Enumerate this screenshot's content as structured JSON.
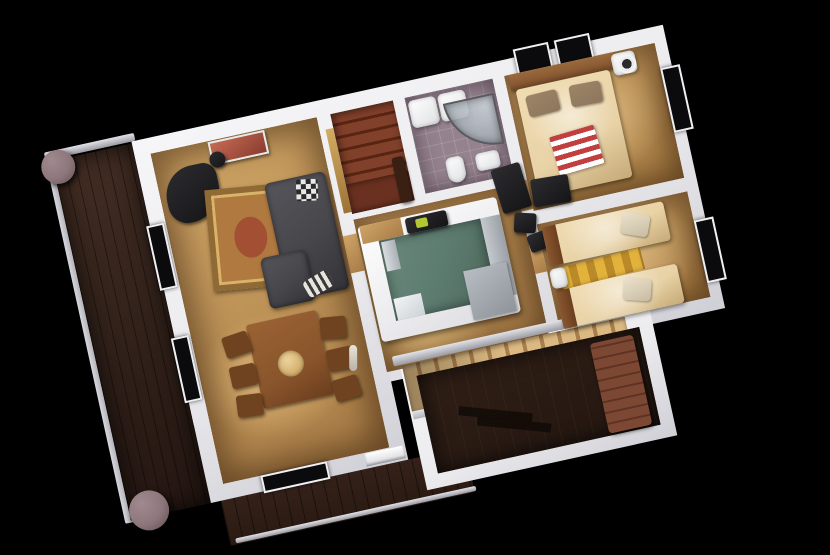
{
  "scene": {
    "type": "3d-rendered-floor-plan",
    "description": "Top-down 3D architectural render of a one-storey home interior on a black background, rotated about -12 degrees",
    "background": "#000000",
    "house_rotation_deg": -12.4
  },
  "palette": {
    "wall": "#ebebee",
    "floor_wood": "#d2a868",
    "floor_wood_dark": "#a87c46",
    "deck_dark": "#35241c",
    "deck_bottom": "#2a1a12",
    "porch_floor": "#241711",
    "bath_tile": "#94828e",
    "kitchen_teal": "#5c7b6f",
    "stairs_up_wood": "#7a3a24",
    "stairs_main_wood": "#d8b57e",
    "bed_linen": "#e8d2a6",
    "pillow_brown": "#8d765c",
    "headboard_wood": "#8a5a33",
    "blanket_red": "#c23f3f",
    "rug_gold": "#8f6a35",
    "rug_center": "#a34f33",
    "rug_yellow": "#d8a434",
    "sofa_gray": "#46464b",
    "dining_wood": "#8a552c",
    "bench_brown": "#6f3f2d",
    "pillar_concrete": "#8d777c",
    "window_glass": "#0b0b0d"
  },
  "rooms": [
    {
      "id": "living-room",
      "furniture": [
        "dark-armchair",
        "ornate-rug",
        "corner-sofa",
        "checkered-pillow",
        "zebra-throw"
      ]
    },
    {
      "id": "dining-area",
      "furniture": [
        "dining-table",
        "six-chairs",
        "centerpiece-bowl",
        "floor-lamp"
      ]
    },
    {
      "id": "kitchen",
      "furniture": [
        "u-shaped-counter",
        "teal-floor",
        "fridge",
        "range",
        "gray-worktop"
      ]
    },
    {
      "id": "bathroom",
      "furniture": [
        "tub-trays",
        "corner-shower",
        "toilet",
        "sink"
      ]
    },
    {
      "id": "master-bedroom",
      "furniture": [
        "double-bed",
        "headboard",
        "two-pillows",
        "red-striped-blanket",
        "nightstand-lamp",
        "black-desk"
      ]
    },
    {
      "id": "twin-bedroom",
      "furniture": [
        "single-bed-1",
        "single-bed-2",
        "yellow-striped-rug",
        "nightstand"
      ]
    },
    {
      "id": "upper-staircase",
      "furniture": [
        "red-brown-steps",
        "gold-door-trim",
        "dark-newel"
      ]
    },
    {
      "id": "main-staircase",
      "furniture": [
        "tan-steps",
        "white-railing"
      ]
    },
    {
      "id": "porch",
      "furniture": [
        "striped-bench",
        "floor-shadow"
      ]
    },
    {
      "id": "side-deck",
      "furniture": [
        "wood-planks",
        "railing",
        "concrete-pillar-top",
        "concrete-pillar-bottom"
      ]
    },
    {
      "id": "lower-deck",
      "furniture": [
        "wood-planks",
        "railing"
      ]
    }
  ]
}
